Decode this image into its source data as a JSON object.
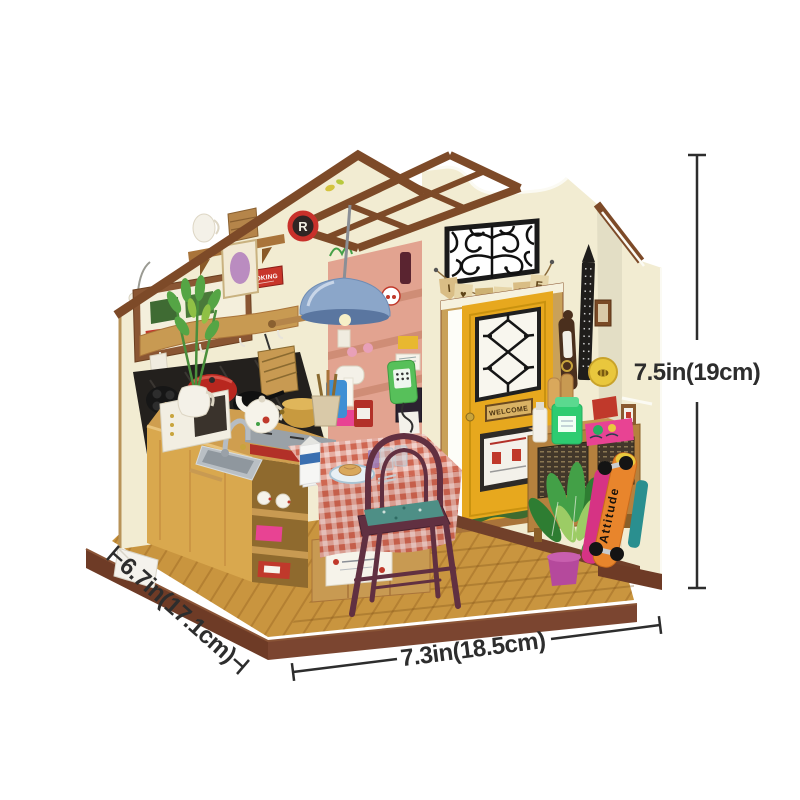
{
  "page": {
    "background": "#ffffff"
  },
  "dimensions": {
    "height_label": "7.5in(19cm)",
    "width_label": "7.3in(18.5cm)",
    "depth_label": "6.7in(17.1cm)"
  },
  "scene": {
    "banner_letters": [
      "I",
      "♥",
      "H",
      "O",
      "M",
      "E"
    ],
    "door_sign": "WELCOME",
    "skateboard_text": "Attitude",
    "cooking_sign": "COOKING",
    "clock_letter": "R"
  },
  "colors": {
    "wall_cream": "#f2ecd2",
    "trim_brown": "#7d4a28",
    "base_brown": "#6e3b26",
    "floor_gold": "#c9953f",
    "door_yellow": "#e7a81e",
    "shelf_pink": "#e2a390",
    "lamp_blue": "#8ba6c9",
    "chair_maroon": "#613041",
    "plant_green": "#43a047",
    "skateboard_orange": "#e8852c",
    "dimension_line": "#2d2d2d"
  }
}
